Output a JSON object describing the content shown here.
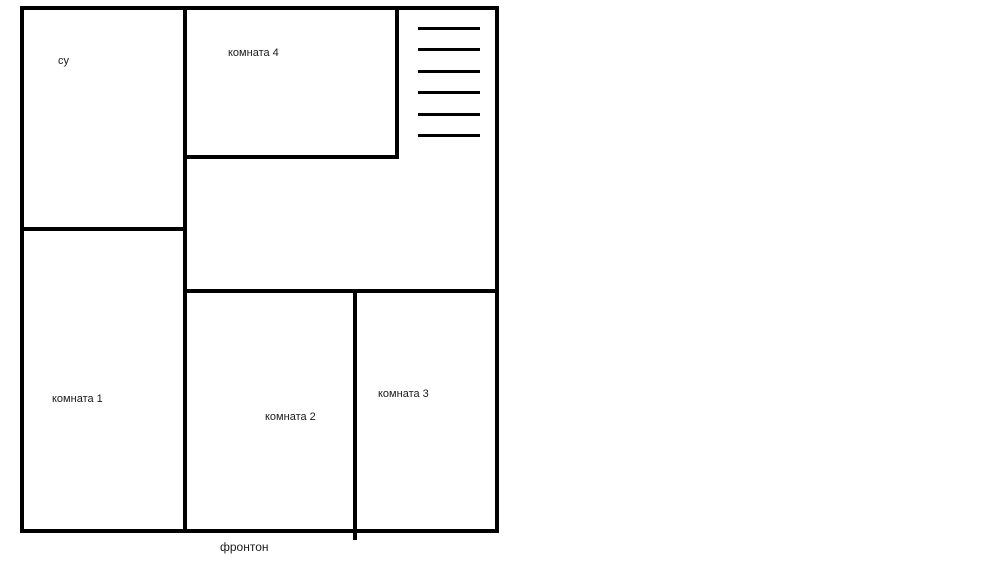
{
  "diagram": {
    "kind": "floor-plan-sketch",
    "background_color": "#ffffff",
    "wall_color": "#000000",
    "text_color": "#1a1a1a",
    "rooms": {
      "su": {
        "label": "су"
      },
      "room4": {
        "label": "комната 4"
      },
      "room1": {
        "label": "комната 1"
      },
      "room2": {
        "label": "комната 2"
      },
      "room3": {
        "label": "комната 3"
      }
    },
    "caption": {
      "label": "фронтон"
    },
    "stairs": {
      "line_count": 6
    }
  }
}
